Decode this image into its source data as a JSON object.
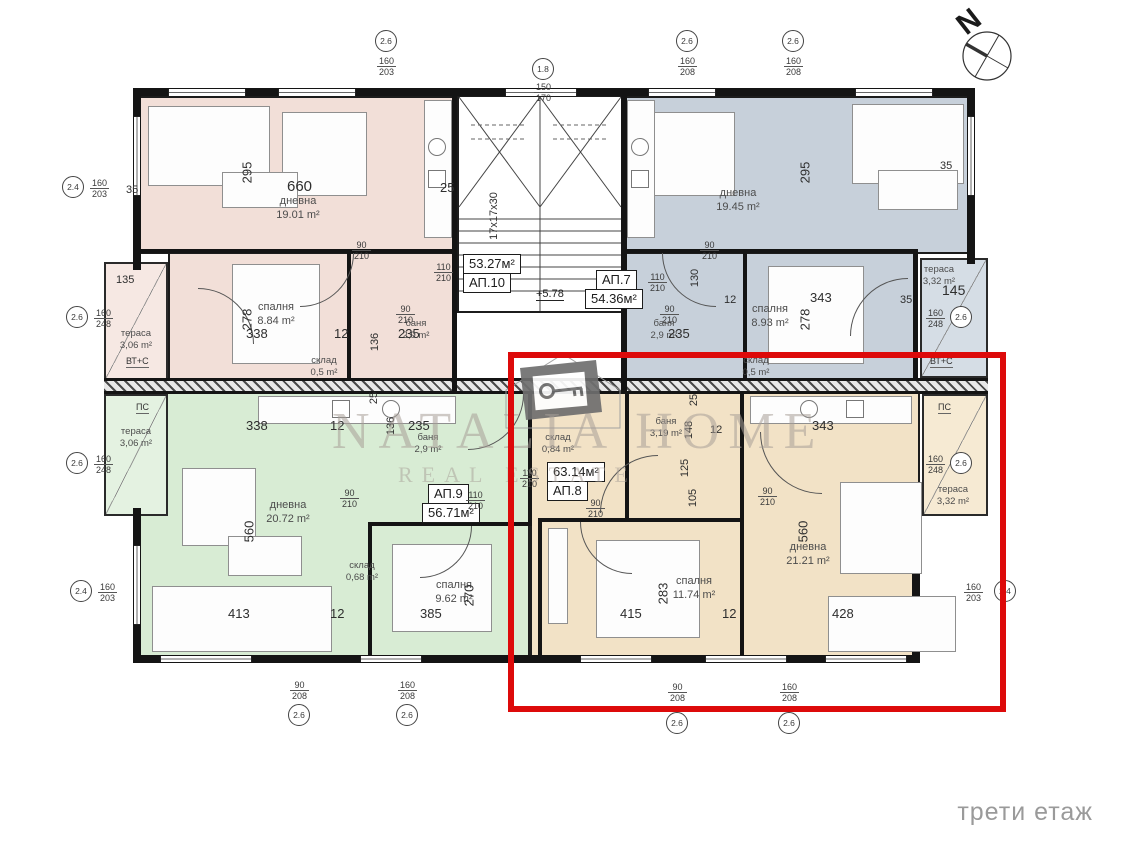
{
  "floor_label": "трети етаж",
  "compass": {
    "letter": "N"
  },
  "watermark": {
    "brand": "NATALIA HOME",
    "tagline": "REAL ESTATE"
  },
  "stair": {
    "steps_label": "17x17x30"
  },
  "level_label": "+5.78",
  "colors": {
    "ap10_fill": "#f2dfd8",
    "ap7_fill": "#c7d0da",
    "ap9_fill": "#d8ecd4",
    "ap8_fill": "#f2e2c6",
    "highlight": "#dd0a0a"
  },
  "apartments": {
    "ap10": {
      "id": "АП.10",
      "total": "53.27м²"
    },
    "ap7": {
      "id": "АП.7",
      "total": "54.36м²"
    },
    "ap9": {
      "id": "АП.9",
      "total": "56.71м²"
    },
    "ap8": {
      "id": "АП.8",
      "total": "63.14м²"
    }
  },
  "rooms": {
    "ap10_living": {
      "name": "дневна",
      "area": "19.01 m²"
    },
    "ap10_bedroom": {
      "name": "спалня",
      "area": "8.84 m²"
    },
    "ap10_bath": {
      "name": "баня",
      "area": "2,9 m²"
    },
    "ap10_storage": {
      "name": "склад",
      "area": "0,5 m²"
    },
    "ap10_terrace": {
      "name": "тераса",
      "area": "3,06 m²"
    },
    "ap7_living": {
      "name": "дневна",
      "area": "19.45 m²"
    },
    "ap7_bedroom": {
      "name": "спалня",
      "area": "8.93 m²"
    },
    "ap7_bath": {
      "name": "баня",
      "area": "2,9 m²"
    },
    "ap7_storage": {
      "name": "склад",
      "area": "0,5 m²"
    },
    "ap7_terrace": {
      "name": "тераса",
      "area": "3,32 m²"
    },
    "ap9_living": {
      "name": "дневна",
      "area": "20.72 m²"
    },
    "ap9_bedroom": {
      "name": "спалня",
      "area": "9.62 m²"
    },
    "ap9_bath": {
      "name": "баня",
      "area": "2,9 m²"
    },
    "ap9_storage": {
      "name": "склад",
      "area": "0,68 m²"
    },
    "ap9_terrace": {
      "name": "тераса",
      "area": "3,06 m²"
    },
    "ap8_living": {
      "name": "дневна",
      "area": "21.21 m²"
    },
    "ap8_bedroom": {
      "name": "спалня",
      "area": "11.74 m²"
    },
    "ap8_bath": {
      "name": "баня",
      "area": "3,19 m²"
    },
    "ap8_storage": {
      "name": "склад",
      "area": "0,84 m²"
    },
    "ap8_terrace": {
      "name": "тераса",
      "area": "3,32 m²"
    }
  },
  "annotations": {
    "vtc": "ВТ+С",
    "ps": "ПС"
  },
  "dims": {
    "d660": "660",
    "d295": "295",
    "d278": "278",
    "d338": "338",
    "d343": "343",
    "d560": "560",
    "d413": "413",
    "d385": "385",
    "d415": "415",
    "d428": "428",
    "d283": "283",
    "d270": "270",
    "d235": "235",
    "d136": "136",
    "d135": "135",
    "d145": "145",
    "d148": "148",
    "d105": "105",
    "d125": "125",
    "d130": "130",
    "d12": "12",
    "d25": "25",
    "d35": "35"
  },
  "fracs": {
    "f90_210": {
      "n": "90",
      "d": "210"
    },
    "f110_210": {
      "n": "110",
      "d": "210"
    },
    "f150_170": {
      "n": "150",
      "d": "170"
    },
    "f160_203": {
      "n": "160",
      "d": "203"
    },
    "f160_208": {
      "n": "160",
      "d": "208"
    },
    "f160_248": {
      "n": "160",
      "d": "248"
    },
    "f90_208": {
      "n": "90",
      "d": "208"
    }
  },
  "markers": {
    "m26": "2.6",
    "m24": "2.4",
    "m18": "1.8"
  }
}
